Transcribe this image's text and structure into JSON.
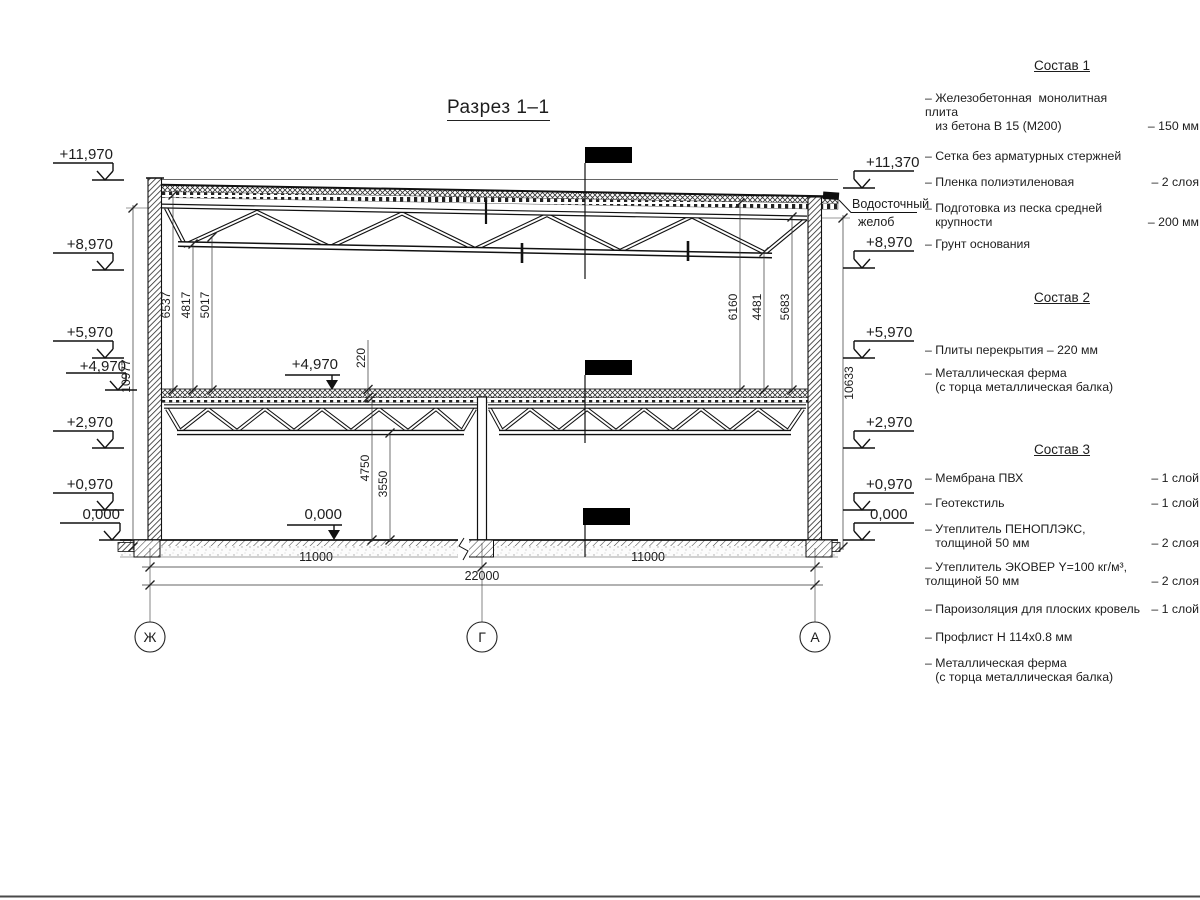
{
  "title": "Разрез 1–1",
  "gutter": {
    "line1": "Водосточный",
    "line2": "желоб"
  },
  "levels": {
    "left": [
      "+11,970",
      "+8,970",
      "+5,970",
      "+4,970",
      "+2,970",
      "+0,970",
      "0,000"
    ],
    "right": [
      "+11,370",
      "+8,970",
      "+5,970",
      "+2,970",
      "+0,970",
      "0,000"
    ],
    "inner": [
      "+4,970",
      "0,000"
    ]
  },
  "dims": {
    "left_overall": "10977",
    "right_overall": "10633",
    "left_heights": [
      "6537",
      "4817",
      "5017"
    ],
    "right_heights": [
      "6160",
      "4481",
      "5683"
    ],
    "slab_thickness": "220",
    "height_to_slab": "4750",
    "height_to_truss": "3550",
    "spans": [
      "11000",
      "11000"
    ],
    "total_span": "22000"
  },
  "axes": [
    "Ж",
    "Г",
    "А"
  ],
  "compositions": [
    {
      "heading": "Состав 1",
      "items": [
        {
          "text": "– Железобетонная  монолитная плита\n   из бетона В 15 (М200)",
          "value": "– 150 мм"
        },
        {
          "text": "– Сетка без арматурных стержней",
          "value": ""
        },
        {
          "text": "– Пленка полиэтиленовая",
          "value": "– 2 слоя"
        },
        {
          "text": "– Подготовка из песка средней\n   крупности",
          "value": "– 200 мм"
        },
        {
          "text": "– Грунт основания",
          "value": ""
        }
      ]
    },
    {
      "heading": "Состав 2",
      "items": [
        {
          "text": "– Плиты перекрытия – 220 мм",
          "value": ""
        },
        {
          "text": "– Металлическая ферма\n   (с торца металлическая балка)",
          "value": ""
        }
      ]
    },
    {
      "heading": "Состав 3",
      "items": [
        {
          "text": "– Мембрана ПВХ",
          "value": "– 1 слой"
        },
        {
          "text": "– Геотекстиль",
          "value": "– 1 слой"
        },
        {
          "text": "– Утеплитель ПЕНОПЛЭКС,\n   толщиной 50 мм",
          "value": "– 2 слоя"
        },
        {
          "text": "– Утеплитель ЭКОВЕР Y=100 кг/м³,\nтолщиной 50 мм",
          "value": "– 2 слоя"
        },
        {
          "text": "– Пароизоляция для плоских кровель",
          "value": "– 1 слой"
        },
        {
          "text": "– Профлист Н 114х0.8 мм",
          "value": ""
        },
        {
          "text": "– Металлическая ферма\n   (с торца металлическая балка)",
          "value": ""
        }
      ]
    }
  ]
}
